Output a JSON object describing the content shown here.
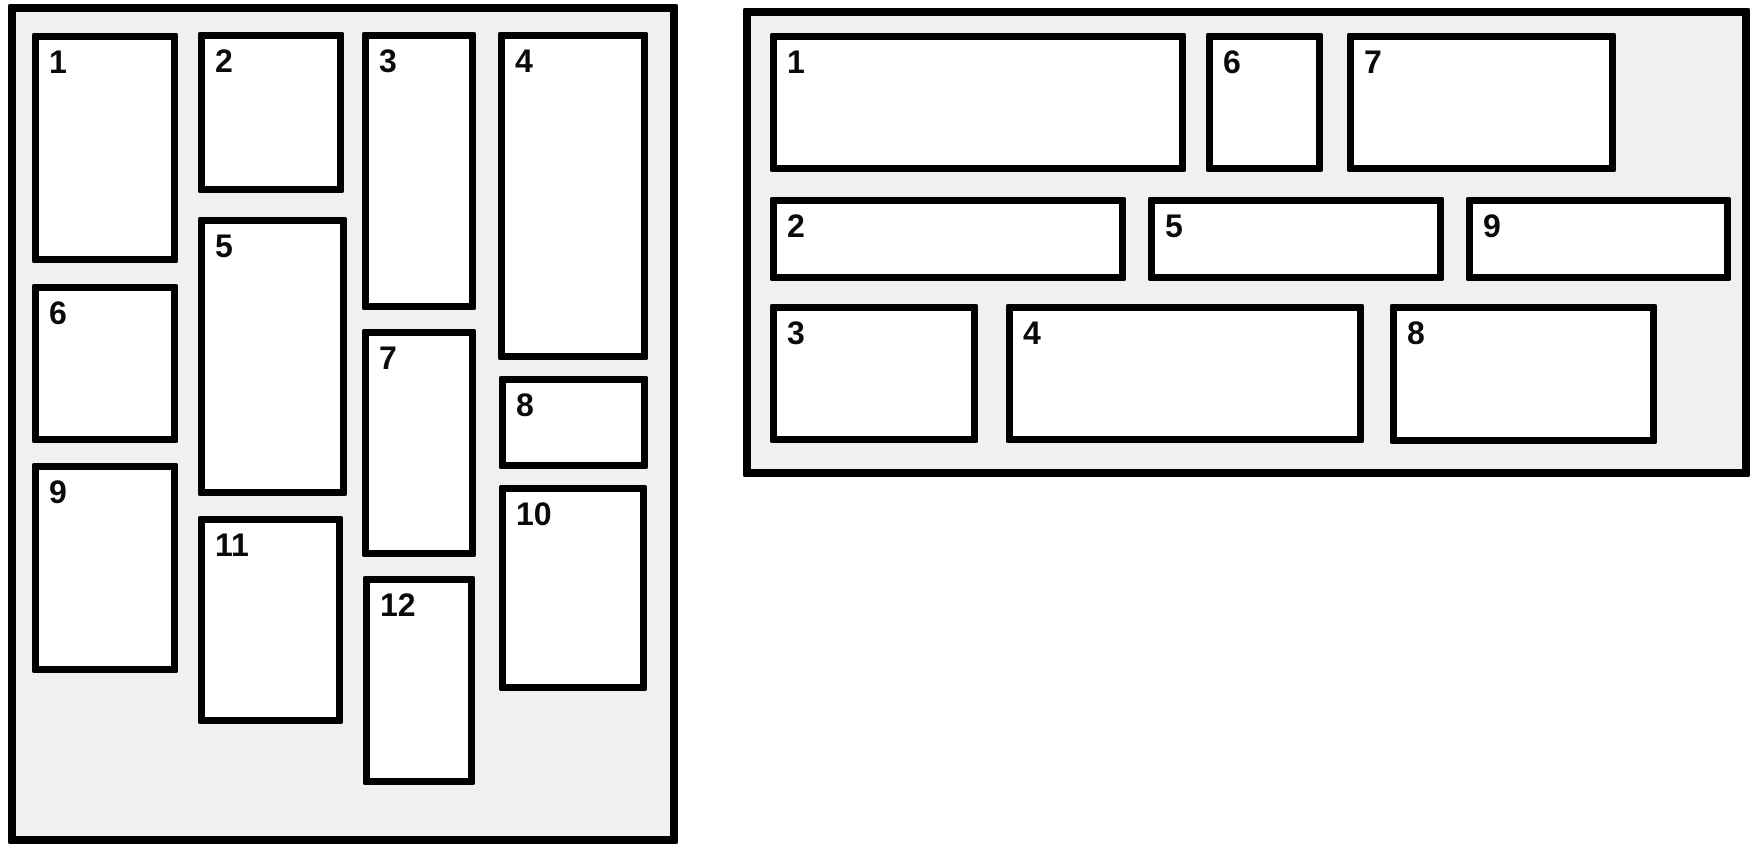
{
  "diagram": {
    "description": "Two masonry layout panels with numbered tiles"
  },
  "colors": {
    "page_bg": "#ffffff",
    "panel_bg": "#f0f0f0",
    "box_bg": "#ffffff",
    "line": "#000000",
    "label": "#0a0a0a"
  },
  "panels": [
    {
      "id": "vertical-masonry",
      "frame": {
        "left": 8,
        "top": 4,
        "width": 670,
        "height": 840
      },
      "boxes": [
        {
          "label": "1",
          "x": 16,
          "y": 21,
          "w": 146,
          "h": 230
        },
        {
          "label": "2",
          "x": 182,
          "y": 20,
          "w": 146,
          "h": 161
        },
        {
          "label": "3",
          "x": 346,
          "y": 20,
          "w": 114,
          "h": 278
        },
        {
          "label": "4",
          "x": 482,
          "y": 20,
          "w": 150,
          "h": 328
        },
        {
          "label": "5",
          "x": 182,
          "y": 205,
          "w": 149,
          "h": 279
        },
        {
          "label": "6",
          "x": 16,
          "y": 272,
          "w": 146,
          "h": 159
        },
        {
          "label": "7",
          "x": 346,
          "y": 317,
          "w": 114,
          "h": 228
        },
        {
          "label": "8",
          "x": 483,
          "y": 364,
          "w": 149,
          "h": 93
        },
        {
          "label": "9",
          "x": 16,
          "y": 451,
          "w": 146,
          "h": 210
        },
        {
          "label": "10",
          "x": 483,
          "y": 473,
          "w": 148,
          "h": 206
        },
        {
          "label": "11",
          "x": 182,
          "y": 504,
          "w": 145,
          "h": 208
        },
        {
          "label": "12",
          "x": 347,
          "y": 564,
          "w": 112,
          "h": 209
        }
      ]
    },
    {
      "id": "horizontal-masonry",
      "frame": {
        "left": 743,
        "top": 8,
        "width": 1007,
        "height": 469
      },
      "boxes": [
        {
          "label": "1",
          "x": 19,
          "y": 17,
          "w": 416,
          "h": 139
        },
        {
          "label": "2",
          "x": 19,
          "y": 181,
          "w": 356,
          "h": 84
        },
        {
          "label": "3",
          "x": 19,
          "y": 288,
          "w": 208,
          "h": 139
        },
        {
          "label": "4",
          "x": 255,
          "y": 288,
          "w": 358,
          "h": 139
        },
        {
          "label": "5",
          "x": 397,
          "y": 181,
          "w": 296,
          "h": 84
        },
        {
          "label": "6",
          "x": 455,
          "y": 17,
          "w": 117,
          "h": 139
        },
        {
          "label": "7",
          "x": 596,
          "y": 17,
          "w": 269,
          "h": 139
        },
        {
          "label": "8",
          "x": 639,
          "y": 288,
          "w": 267,
          "h": 140
        },
        {
          "label": "9",
          "x": 715,
          "y": 181,
          "w": 265,
          "h": 84
        }
      ]
    }
  ]
}
